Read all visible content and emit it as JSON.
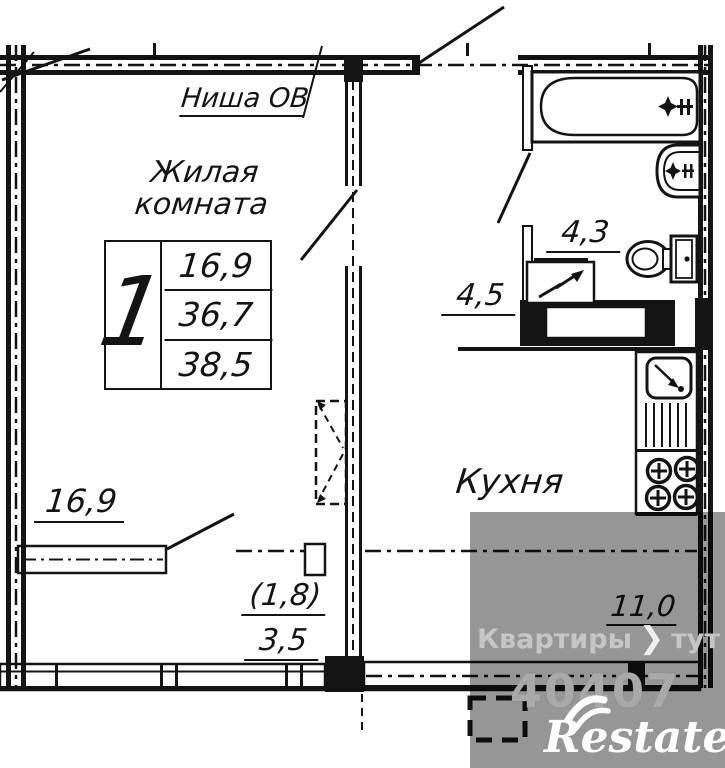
{
  "plan": {
    "labels": {
      "niche": "Ниша ОВ",
      "living_room_line1": "Жилая",
      "living_room_line2": "комната",
      "kitchen": "Кухня",
      "living_area": "16,9",
      "kitchen_area": "11,0",
      "hall_area": "4,5",
      "bathroom_area": "4,3",
      "loggia_reduced_area": "(1,8)",
      "loggia_area": "3,5"
    },
    "info_table": {
      "rooms_count": "1",
      "living_area": "16,9",
      "area": "36,7",
      "total_area": "38,5"
    }
  },
  "watermark": {
    "site_word1": "Квартиры",
    "chevron": "❯",
    "site_word2": "тут",
    "listing_id": "40407",
    "logo": "Restate"
  },
  "colors": {
    "line": "#141414",
    "overlay_gray": "#969696",
    "wm_text_gray": "#c6c6c6",
    "logo_white": "#ffffff"
  }
}
